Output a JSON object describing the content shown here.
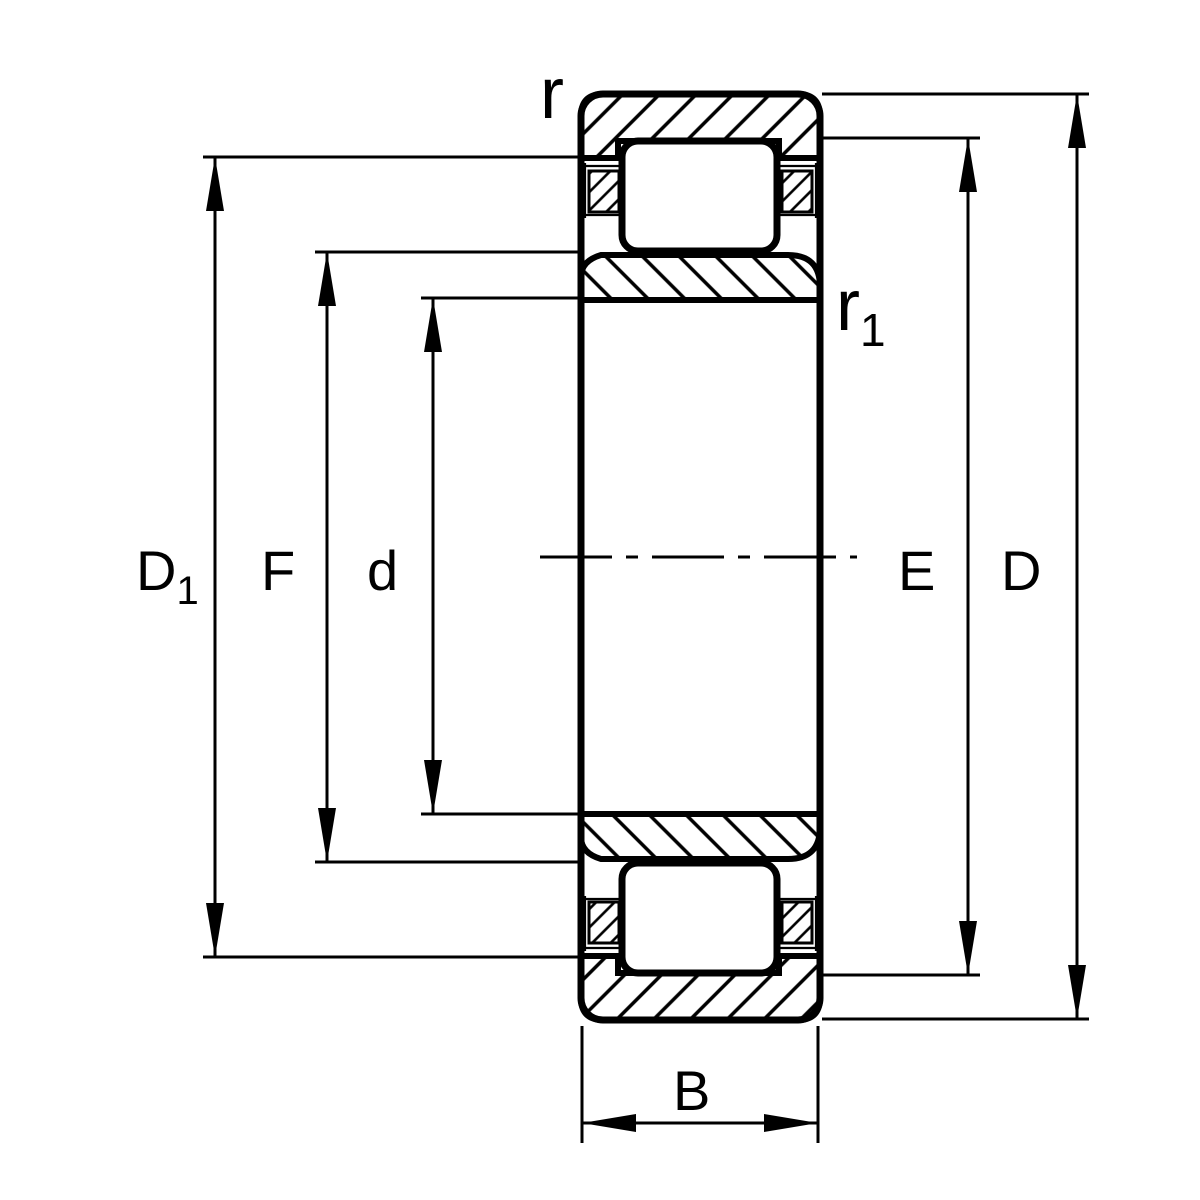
{
  "diagram": {
    "type": "cylindrical roller bearing cross-section drawing",
    "background_color": "#ffffff",
    "line_color": "#000000",
    "labels": {
      "r_outer": "r",
      "r1_main": "r",
      "r1_sub": "1",
      "D1_main": "D",
      "D1_sub": "1",
      "F": "F",
      "d": "d",
      "E": "E",
      "D": "D",
      "B": "B"
    }
  }
}
